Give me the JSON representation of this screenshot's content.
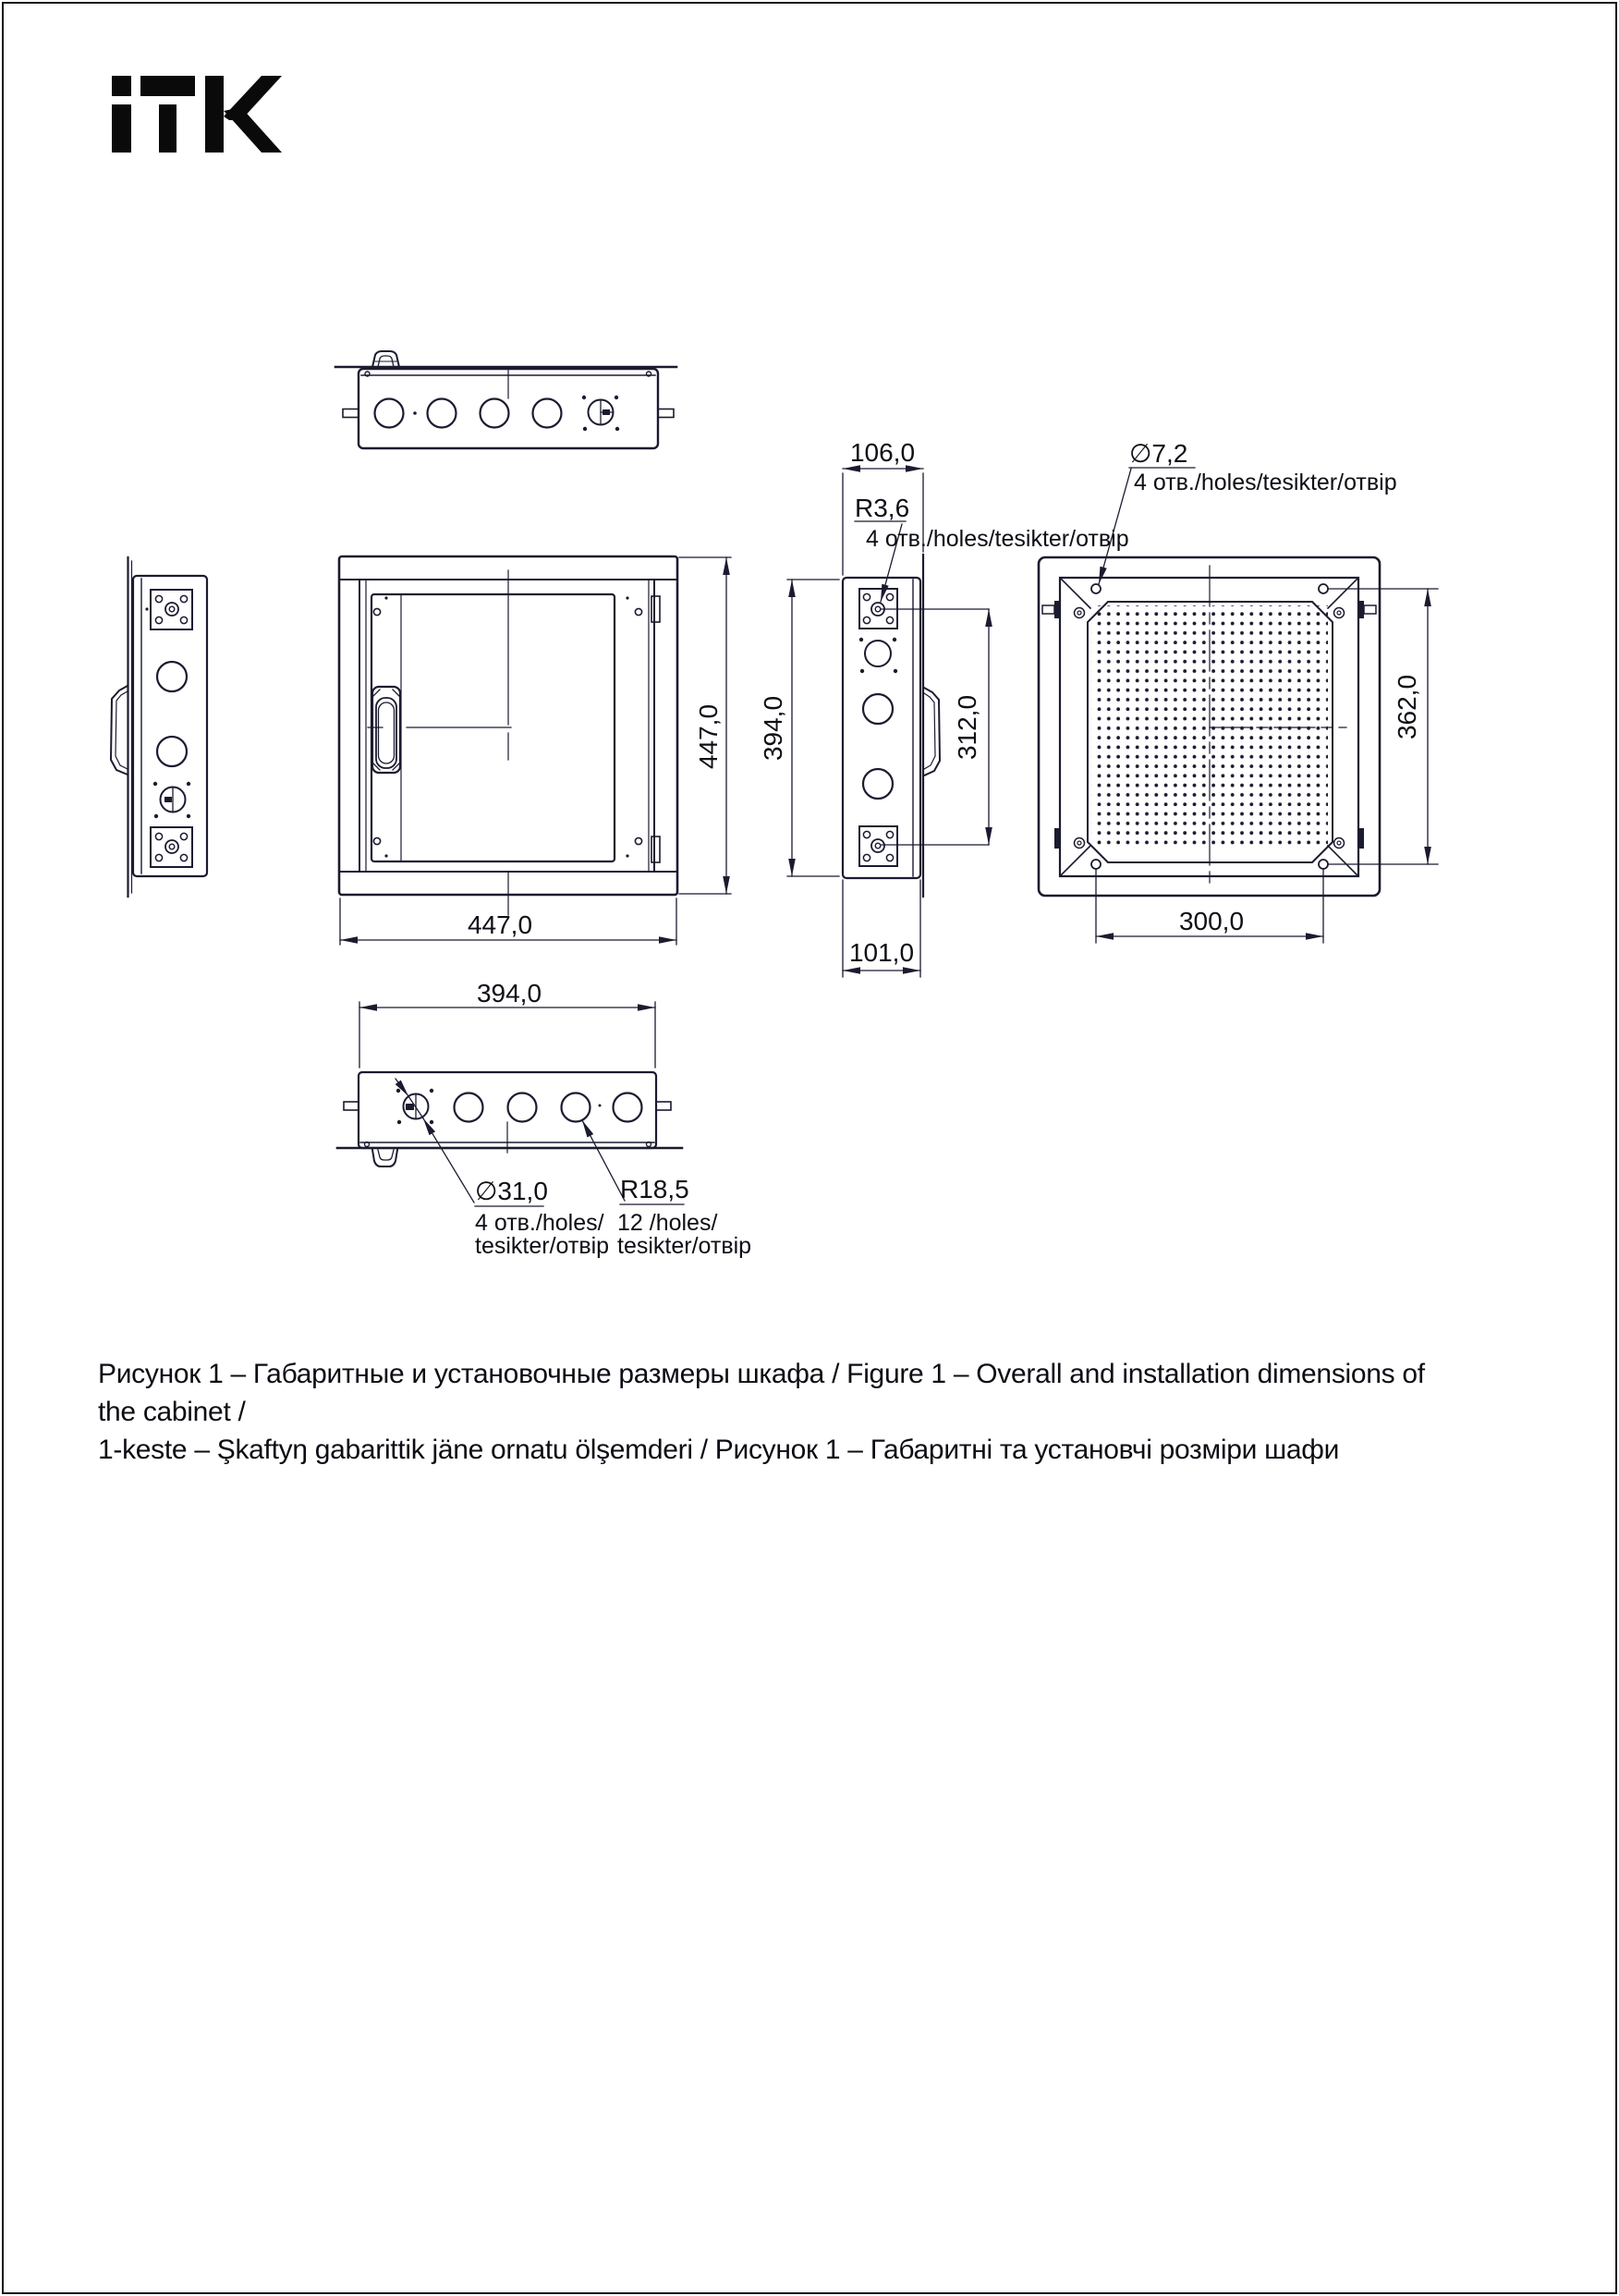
{
  "page": {
    "background": "#ffffff",
    "line_color": "#1b1b30",
    "text_color": "#0e0e16"
  },
  "logo": {
    "text": "ITK"
  },
  "dimensions": {
    "front_width": "447,0",
    "front_height": "447,0",
    "side_depth_top": "106,0",
    "side_height": "394,0",
    "plate_span": "312,0",
    "side_depth_bottom": "101,0",
    "back_hole_span_vertical": "362,0",
    "back_hole_span_horizontal": "300,0",
    "bottom_width": "394,0",
    "corner_radius": "R3,6",
    "back_hole_diameter": "∅7,2",
    "bottom_hole_diameter": "∅31,0",
    "bottom_hole_radius": "R18,5"
  },
  "annotations": {
    "holes4_full_top": "4 отв./holes/tesikter/отвір",
    "holes4_full_back": "4 отв./holes/tesikter/отвір",
    "holes4_line1": "4 отв./holes/",
    "holes4_line2": "tesikter/отвір",
    "holes12_line1": "12 /holes/",
    "holes12_line2": "tesikter/отвір"
  },
  "caption": {
    "line1": "Рисунок  1 – Габаритные и установочные размеры шкафа / Figure 1 – Overall and installation dimensions of the cabinet /",
    "line2": "1-keste – Şkaftyŋ gabarittik jäne ornatu ölşemderi / Рисунок 1 – Габаритні та установчі розміри шафи"
  }
}
